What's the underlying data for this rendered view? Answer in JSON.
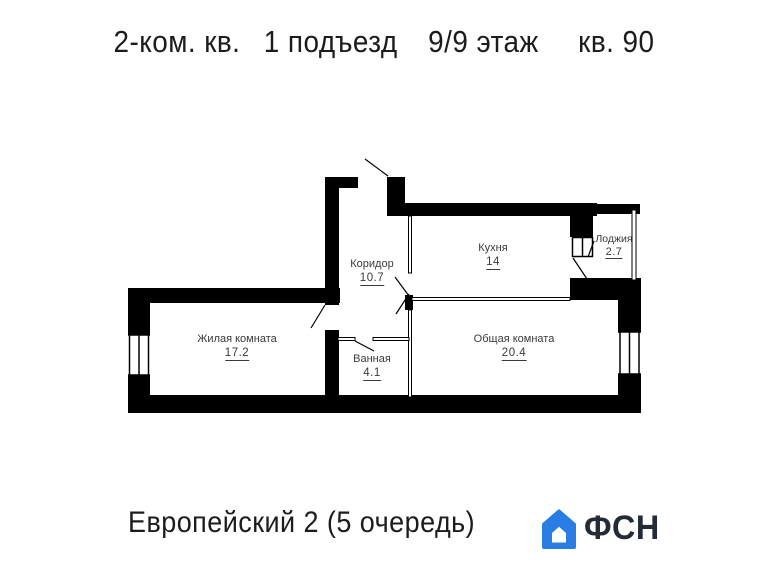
{
  "title": {
    "parts": [
      "2-ком. кв.",
      "1 подъезд",
      "9/9 этаж",
      "кв. 90"
    ]
  },
  "rooms": [
    {
      "name": "Жилая комната",
      "area": "17.2"
    },
    {
      "name": "Коридор",
      "area": "10.7"
    },
    {
      "name": "Кухня",
      "area": "14"
    },
    {
      "name": "Лоджия",
      "area": "2.7"
    },
    {
      "name": "Ванная",
      "area": "4.1"
    },
    {
      "name": "Общая комната",
      "area": "20.4"
    }
  ],
  "footer": {
    "project": "Европейский 2 (5 очередь)",
    "logo_text": "ФСН"
  },
  "icons": [
    {
      "name": "fsn-house-logo-icon",
      "meaning": "blue house logo of FSN developer"
    }
  ],
  "colors": {
    "wall": "#000000",
    "label_text": "#3a3a3a",
    "title_text": "#1c1c1c",
    "logo_blue": "#2a7de2",
    "logo_dark": "#222b36",
    "background": "#ffffff"
  }
}
